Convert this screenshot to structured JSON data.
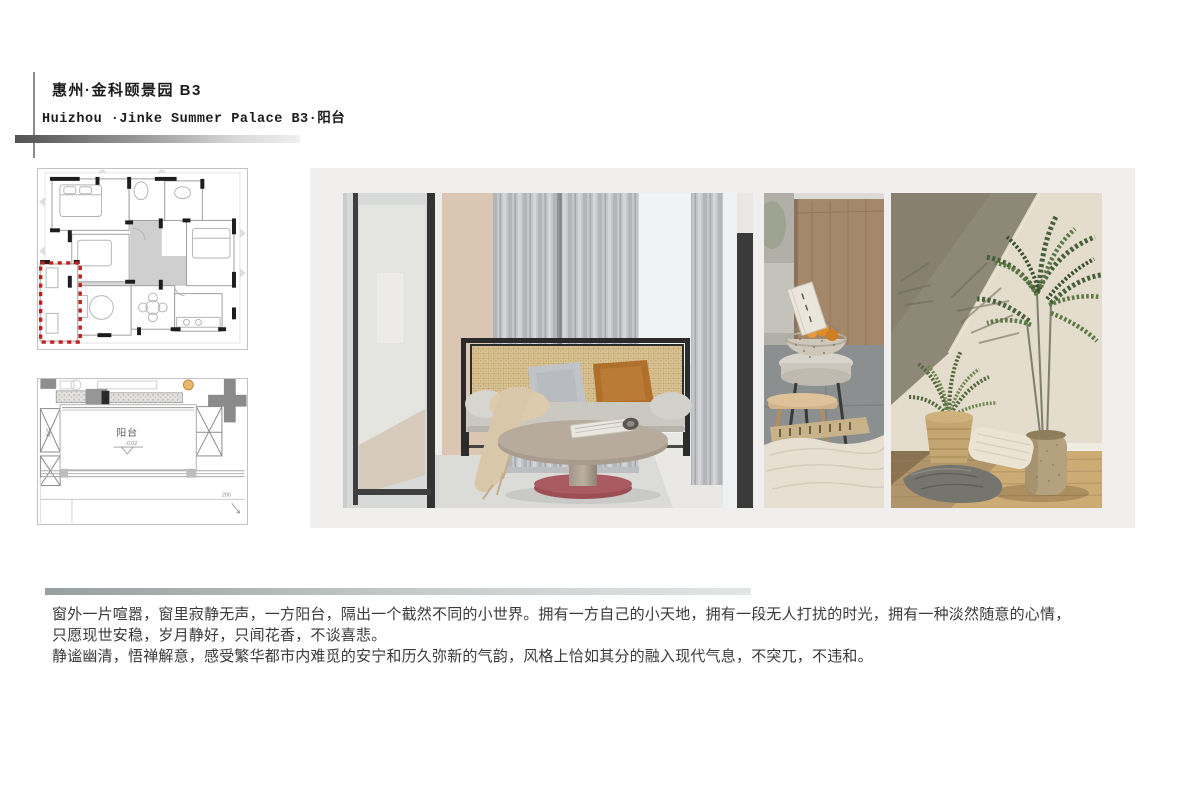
{
  "header": {
    "title_cn": "惠州·金科颐景园 B3",
    "title_en": "Huizhou ·Jinke Summer Palace B3·阳台"
  },
  "plan_detail": {
    "room_label": "阳台",
    "level_label": "-0.02",
    "ac_label": "A/C",
    "dim_label": "200"
  },
  "description": {
    "line1": "窗外一片喧嚣，窗里寂静无声，一方阳台，隔出一个截然不同的小世界。拥有一方自己的小天地，拥有一段无人打扰的时光，拥有一种淡然随意的心情，",
    "line2": "只愿现世安稳，岁月静好，只闻花香，不谈喜悲。",
    "line3": "静谧幽清，悟禅解意，感受繁华都市内难觅的安宁和历久弥新的气韵，风格上恰如其分的融入现代气息，不突兀，不违和。"
  },
  "colors": {
    "highlight_red": "#c41d1d",
    "panel_bg": "#f0efee",
    "header_bar_from": "#525252",
    "header_bar_to": "#efefef",
    "divider_from": "#96a09e",
    "divider_to": "#e2e6e5",
    "table_base_maroon": "#9c4e55",
    "pillow_orange": "#b06f2b",
    "rattan_tan": "#d9c495",
    "palm_green": "#4a6238"
  }
}
